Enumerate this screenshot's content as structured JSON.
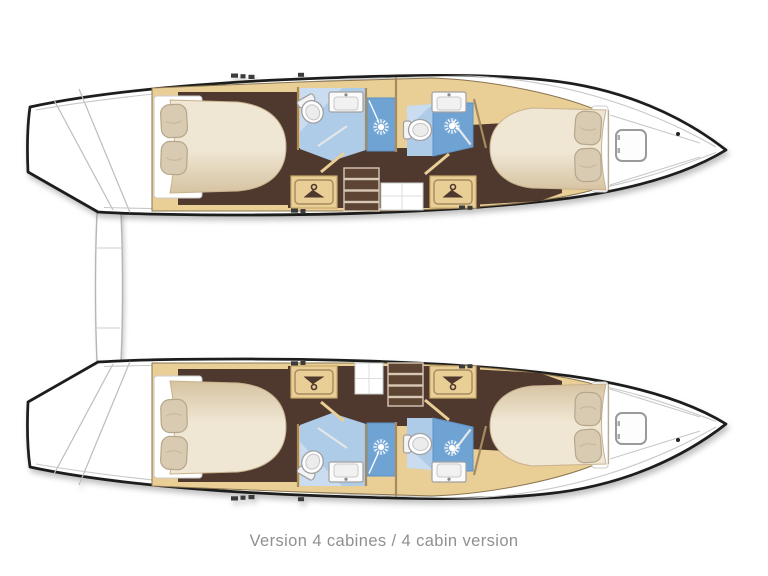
{
  "caption": "Version 4 cabines / 4 cabin version",
  "palette": {
    "hull_outline": "#1d1d1b",
    "deck_white": "#ffffff",
    "deck_line": "#c8c8c8",
    "wood": "#e9ce96",
    "wood_line": "#a58b5e",
    "wood_trim": "#c9a96a",
    "floor_dark": "#4f382d",
    "stair_tread": "#5e4433",
    "stair_edge": "#d8c8b6",
    "mattress_light": "#efe6d3",
    "mattress_dark": "#d6c3a1",
    "pillow": "#d9cbb2",
    "pillow_line": "#b6a68a",
    "bath_floor": "#aecbe8",
    "bath_floor_light": "#c9dcf0",
    "shower_stall": "#6fa3d4",
    "fixture_white": "#fbfbfb",
    "fixture_line": "#a0a0a0",
    "window_dash": "#3b3b3b",
    "caption_text": "#8f9092"
  },
  "icons": {
    "shower_head": "sunburst-rays",
    "wardrobe": "clothes-hanger",
    "toilet": "oval-bowl-with-tank",
    "sink": "rounded-basin-with-faucet",
    "bow_hatch": "rounded-square"
  }
}
